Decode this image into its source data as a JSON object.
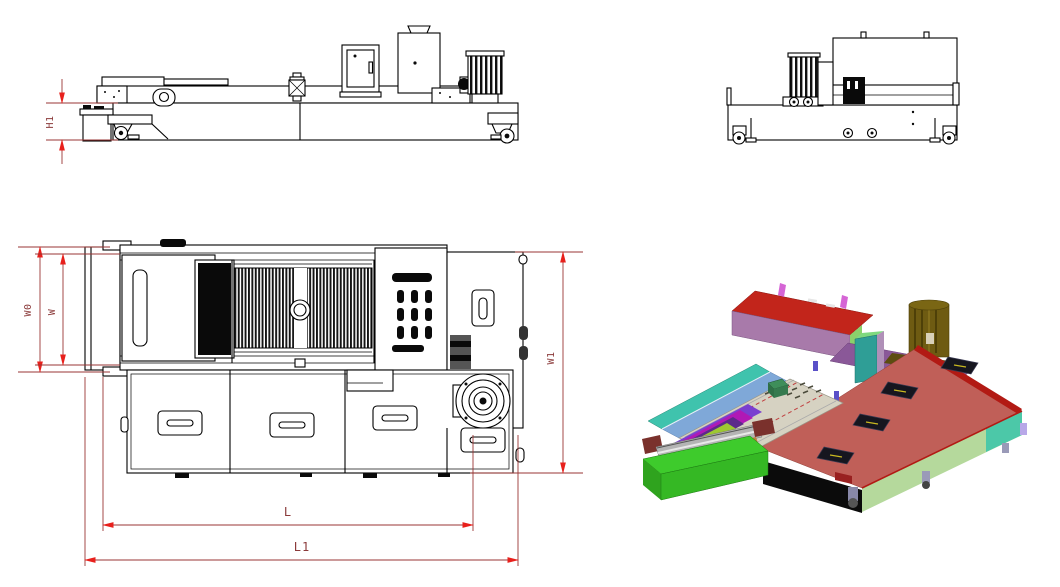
{
  "page": {
    "background_color": "#ffffff"
  },
  "drawing": {
    "kind": "machine-engineering-drawing",
    "dimensions": {
      "h1": "H1",
      "w0": "W0",
      "w": "W",
      "w1": "W1",
      "l": "L",
      "l1": "L1"
    },
    "colors": {
      "line": "#000000",
      "dimension_line": "#9a3634",
      "dimension_label": "#8b3a3a",
      "dimension_arrow": "#e8201c",
      "render": {
        "tray_green": "#3ecb2c",
        "base_black": "#0b0b0b",
        "deck_salmon": "#c05f58",
        "deck_edge_red": "#b21a14",
        "side_sage": "#b5d99c",
        "side_teal": "#4cc8a8",
        "tank_top_red": "#c2251b",
        "tank_front_mauve": "#a87aaa",
        "tank_side_green": "#8bd16b",
        "hook_pink": "#d565d5",
        "strip_purple": "#8a5898",
        "motor_olive": "#6e5b12",
        "cabinet_teal": "#2f9e96",
        "belt_beige": "#d6d2c2",
        "rail_blue": "#7fa8d8",
        "conveyor_teal": "#3fc3ad",
        "roller_magenta": "#b019b5",
        "roller_violet": "#7a3fd0",
        "roller_purple": "#5c2a8a",
        "edge_yellowgreen": "#9ec832",
        "drum_grey": "#b4b4b4",
        "block_maroon": "#7a312c",
        "strip_tan": "#c08040",
        "hatch_dark": "#16161f",
        "hatch_slash_yellow": "#c8b820",
        "cube_green": "#3e8e5a",
        "caster_lavender": "#9a9ab8"
      }
    }
  }
}
